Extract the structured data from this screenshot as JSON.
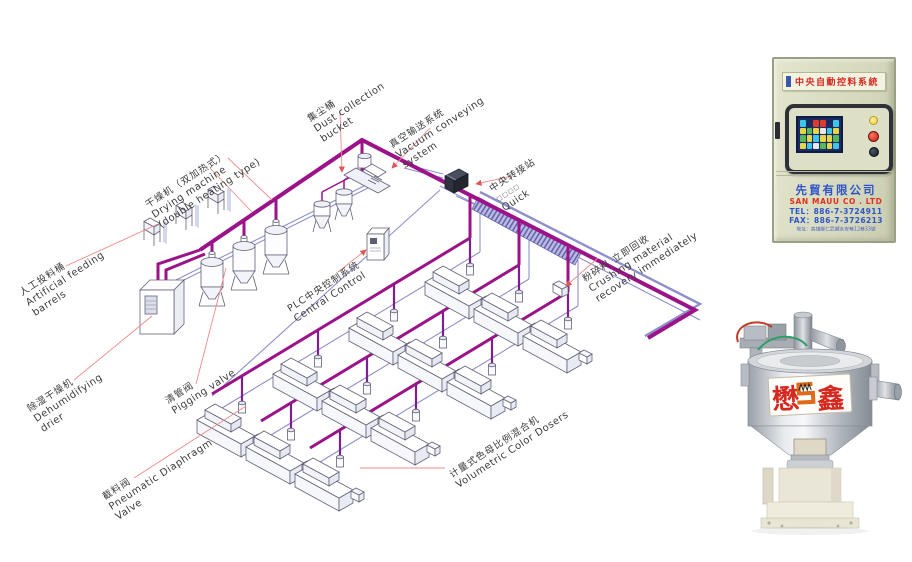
{
  "page": {
    "background": "#ffffff"
  },
  "diagram": {
    "labels": {
      "artificial": {
        "cn": "人工投料桶",
        "en1": "Artificial feeding",
        "en2": "barrels"
      },
      "drying": {
        "cn": "干燥机（双加热式）",
        "en1": "Drying machine",
        "en2": "(double heating type)"
      },
      "dust": {
        "cn": "集尘桶",
        "en1": "Dust collection",
        "en2": "bucket"
      },
      "vacuum": {
        "cn": "真空输送系统",
        "en1": "Vacuum conveying",
        "en2": "system"
      },
      "transfer": {
        "cn": "中央转接站",
        "sub": "□□□□",
        "en1": "Quick"
      },
      "plc": {
        "cn": "PLC中央控制系统",
        "en1": "Central Control"
      },
      "crushing": {
        "cn": "粉碎料 立即回收",
        "en1": "Crushing material",
        "en2": "recovery immediately"
      },
      "dehumidifying": {
        "cn": "除湿干燥机",
        "en1": "Dehumidifying",
        "en2": "drier"
      },
      "pigging": {
        "cn": "清管阀",
        "en1": "Pigging valve"
      },
      "diaphragm": {
        "cn": "截料阀",
        "en1": "Pneumatic Diaphragm",
        "en2": "Valve"
      },
      "doser": {
        "cn": "计量式色母比例混合机",
        "en1": "Volumetric Color Dosers"
      }
    },
    "colors": {
      "pipe_magenta": "#9c1389",
      "pipe_drop": "#7d1f8e",
      "pipe_blue": "#8f8fcb",
      "leader_red": "#ef8a8a"
    }
  },
  "control_panel": {
    "plate_title": "中央自動控料系統",
    "company_cn": "先貿有限公司",
    "company_en": "SAN MAUU CO . LTD",
    "tel": "TEL：886-7-3724911",
    "fax": "FAX：886-7-3726213",
    "address": "地址：高雄縣仁武鄉永安巷12巷33號",
    "screen_cells": [
      "#3ec6e8",
      "#1a2a5e",
      "#e03a2a",
      "#e03a2a",
      "#1a2a5e",
      "#3ec6e8",
      "#e8d44a",
      "#56b85c",
      "#e8d44a",
      "#e8e8e8",
      "#3ec6e8",
      "#e8d44a",
      "#56b85c",
      "#e8d44a",
      "#3ec6e8",
      "#e8d44a",
      "#e8d44a",
      "#56b85c",
      "#e8d44a",
      "#3ec6e8",
      "#e8e8e8",
      "#56b85c",
      "#e8d44a",
      "#3ec6e8"
    ]
  },
  "hopper": {
    "logo_left": "懋",
    "logo_right": "鑫"
  }
}
